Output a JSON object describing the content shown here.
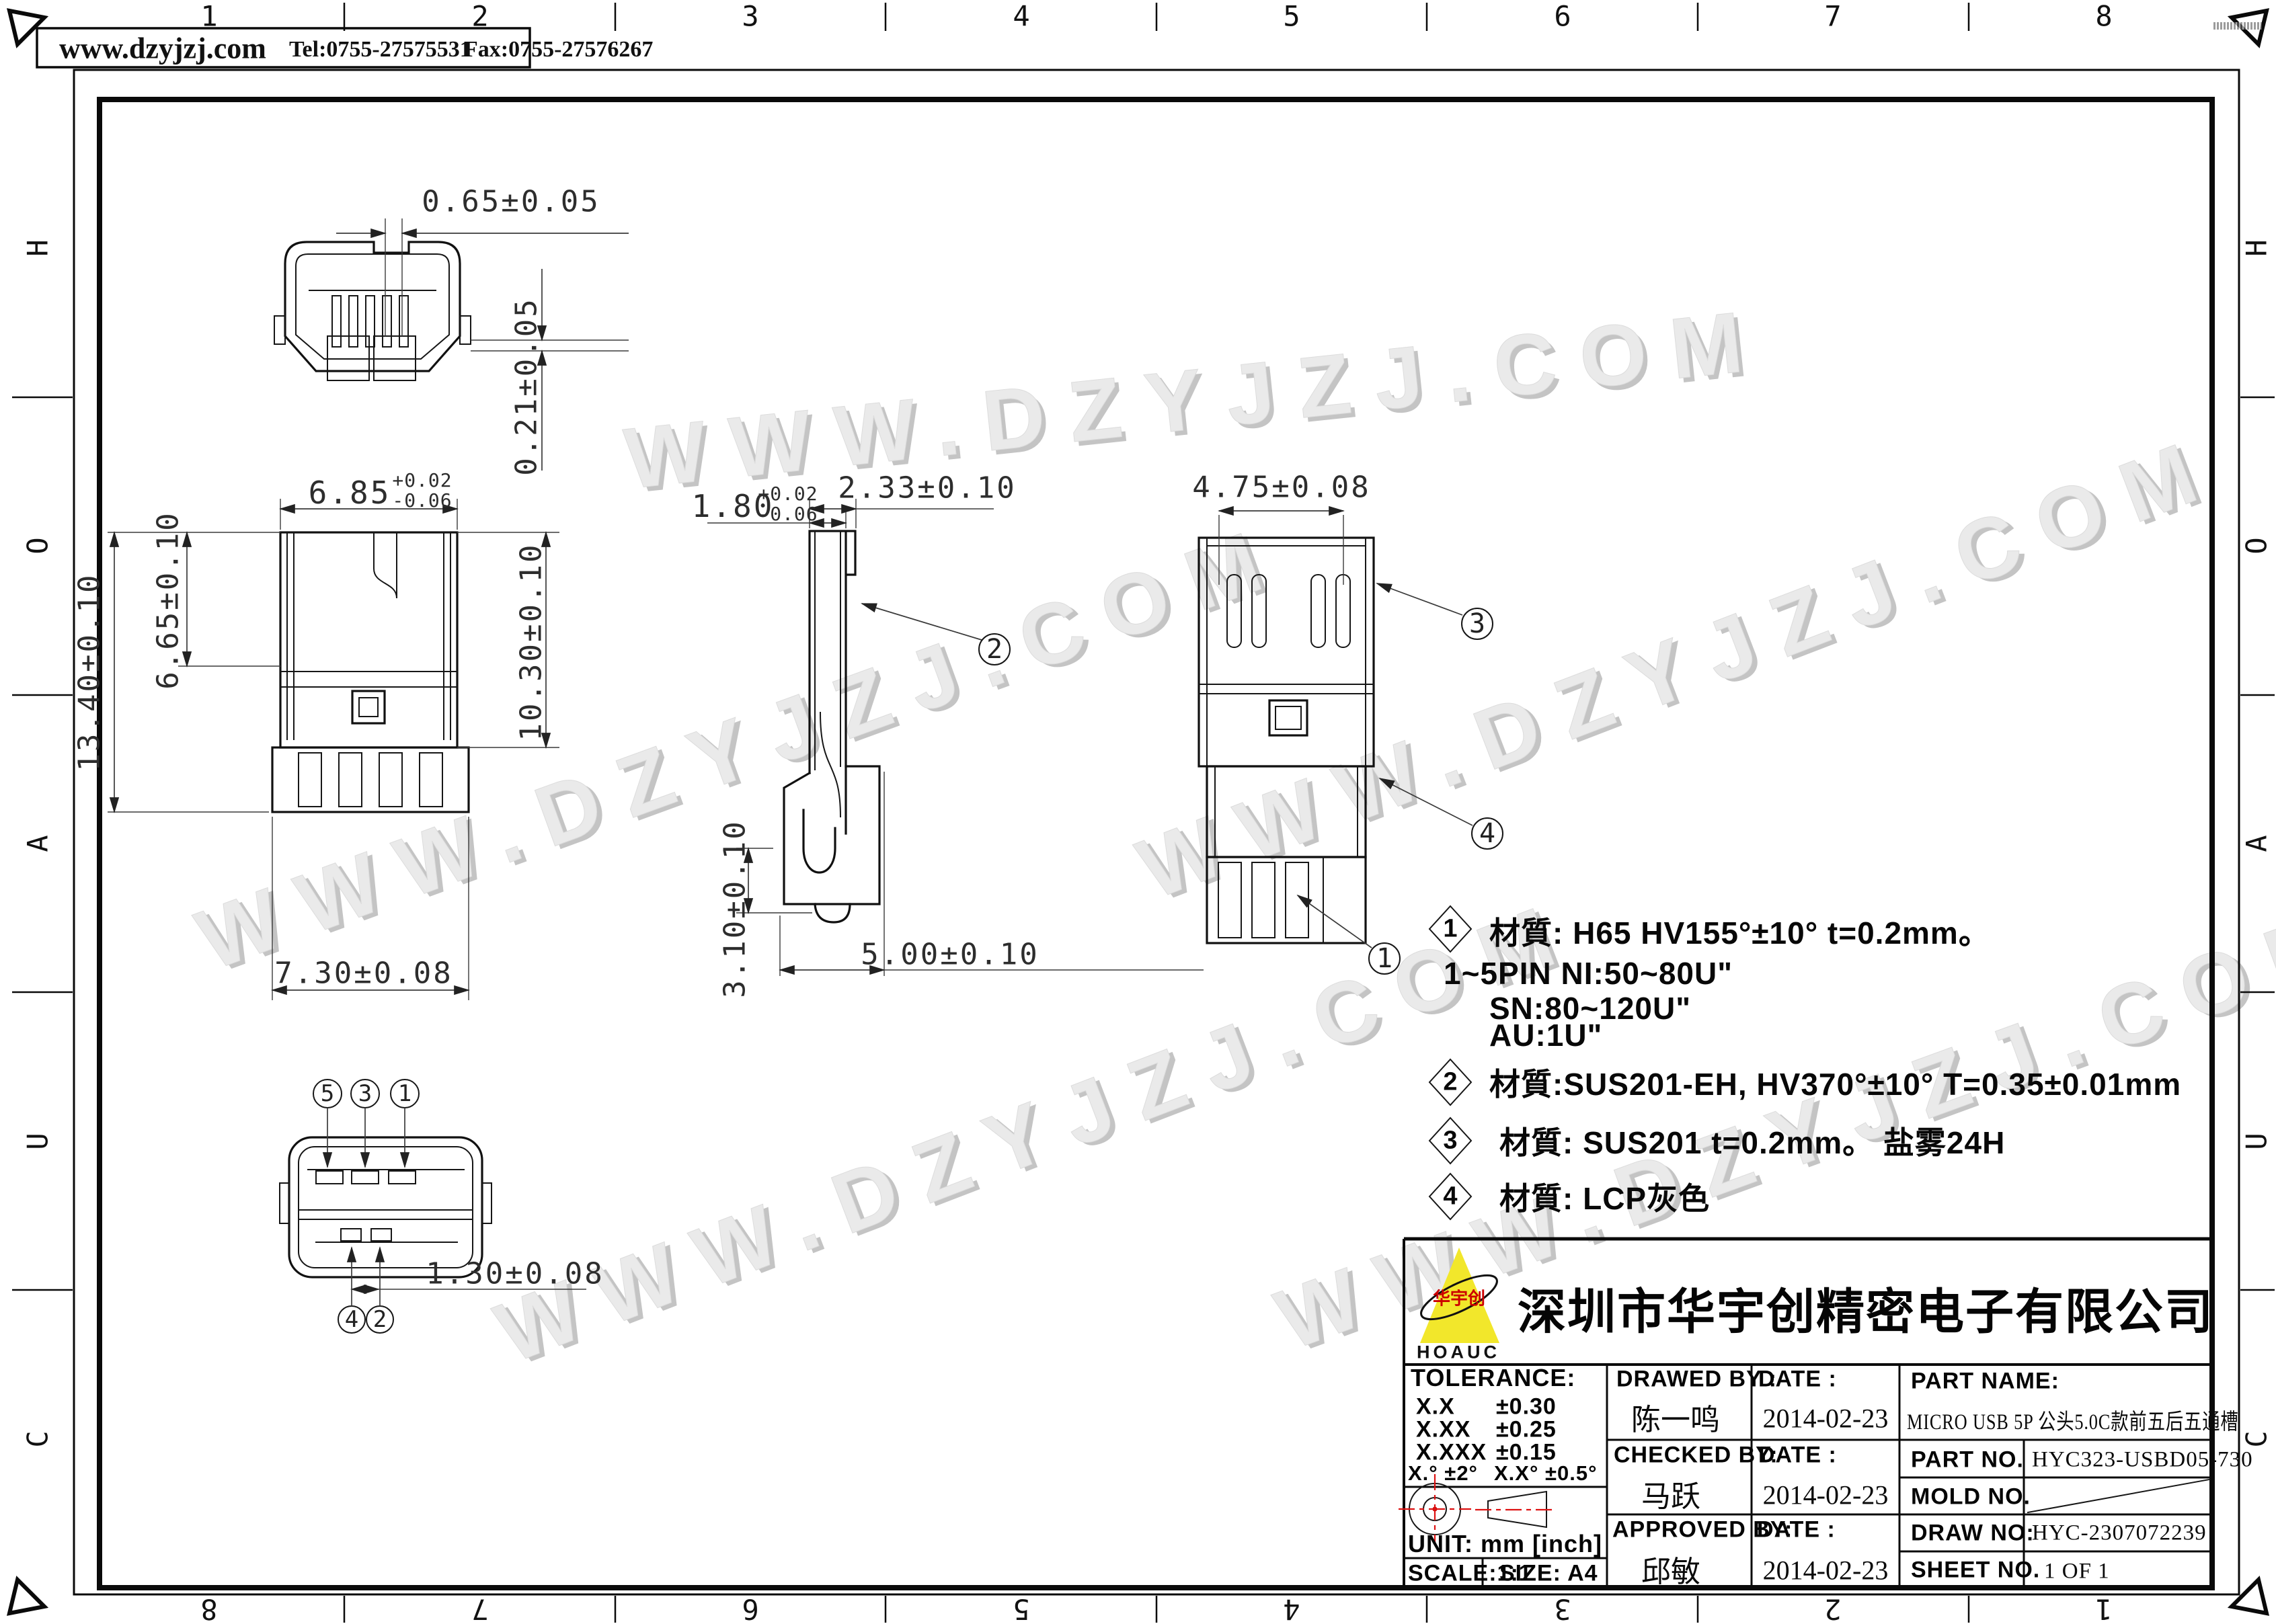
{
  "page": {
    "watermark": "WWW.DZYJZJ.COM"
  },
  "header": {
    "website": "www.dzyjzj.com",
    "tel": "Tel:0755-27575531",
    "fax": "Fax:0755-27576267"
  },
  "zones": {
    "cols": [
      "1",
      "2",
      "3",
      "4",
      "5",
      "6",
      "7",
      "8"
    ],
    "rows": [
      "H",
      "O",
      "A",
      "U",
      "C"
    ]
  },
  "dims": {
    "d065": "0.65±0.05",
    "d021": "0.21±0.05",
    "d685": "6.85",
    "d685_hi": "+0.02",
    "d685_lo": "-0.06",
    "d1340": "13.40±0.10",
    "d665": "6.65±0.10",
    "d1030": "10.30±0.10",
    "d730": "7.30±0.08",
    "d180": "1.80",
    "d180_hi": "+0.02",
    "d180_lo": "-0.06",
    "d233": "2.33±0.10",
    "d310": "3.10±0.10",
    "d500": "5.00±0.10",
    "d475": "4.75±0.08",
    "d130": "1.30±0.08"
  },
  "callouts": {
    "c1": "1",
    "c2": "2",
    "c3": "3",
    "c4": "4"
  },
  "pins": {
    "top": [
      "5",
      "3",
      "1"
    ],
    "bottom": [
      "4",
      "2"
    ]
  },
  "notes": {
    "n1_no": "1",
    "n1": "材質: H65 HV155°±10° t=0.2mm。",
    "plating1": "1~5PIN NI:50~80U\"",
    "plating2": "SN:80~120U\"",
    "plating3": "AU:1U\"",
    "n2_no": "2",
    "n2": "材質:SUS201-EH, HV370°±10° T=0.35±0.01mm",
    "n3_no": "3",
    "n3": "材質: SUS201 t=0.2mm。 盐雾24H",
    "n4_no": "4",
    "n4": "材質: LCP灰色"
  },
  "title_block": {
    "company": "深圳市华宇创精密电子有限公司",
    "logo_text": "华宇创",
    "logo_sub": "HOAUC",
    "tolerance_label": "TOLERANCE:",
    "tol_rows": [
      [
        "X.X",
        "±0.30"
      ],
      [
        "X.XX",
        "±0.25"
      ],
      [
        "X.XXX",
        "±0.15"
      ]
    ],
    "tol_angle1": "X.°  ±2°",
    "tol_angle2": "X.X°  ±0.5°",
    "unit_label": "UNIT:  mm  [inch]",
    "scale_label": "SCALE:1:1",
    "size_label": "SIZE:  A4",
    "drawed_by_label": "DRAWED  BY :",
    "date_label1": "DATE  :",
    "drawed_by": "陈一鸣",
    "drawed_date": "2014-02-23",
    "checked_by_label": "CHECKED  BY:",
    "date_label2": "DATE  :",
    "checked_by": "马跃",
    "checked_date": "2014-02-23",
    "approved_by_label": "APPROVED  BY:",
    "date_label3": "DATE  :",
    "approved_by": "邱敏",
    "approved_date": "2014-02-23",
    "part_name_label": "PART  NAME:",
    "part_name": "MICRO USB 5P 公头5.0C款前五后五通槽",
    "part_no_label": "PART  NO.",
    "part_no": "HYC323-USBD05-730",
    "mold_no_label": "MOLD  NO.",
    "draw_no_label": "DRAW  NO:",
    "draw_no": "HYC-2307072239",
    "sheet_no_label": "SHEET  NO.",
    "sheet_no": "1 OF 1"
  }
}
